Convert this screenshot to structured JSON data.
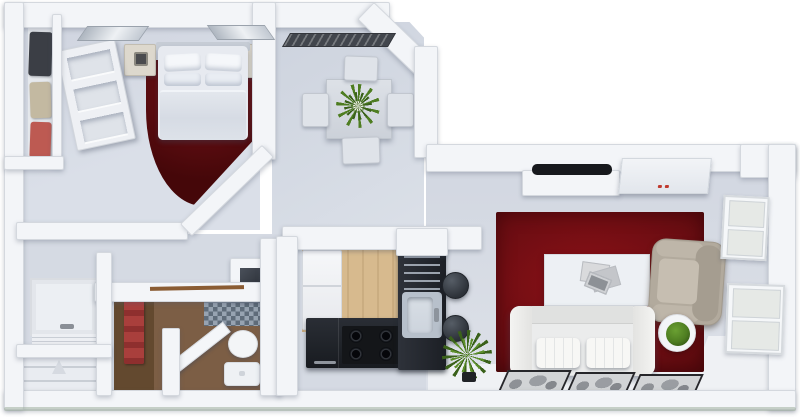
{
  "scene": {
    "description": "3D rendered top-down floor plan of a one-bedroom apartment",
    "view": "top-down orthographic 3D render",
    "background": "#ffffff"
  },
  "palette": {
    "wall": "#f3f5f8",
    "wall_line": "#d4d8de",
    "floor": "#d5dae3",
    "floor_bright": "#eff1f4",
    "wood": "#d7ba8e",
    "rug_bed_center": "#7c1316",
    "rug_bed_edge": "#450709",
    "rug_liv_center": "#8c1117",
    "rug_liv_edge": "#5c0a0e",
    "counter_dark": "#22262c",
    "counter_side": "#2e323a",
    "steel": "#b7c0cb",
    "sink_basin": "#cdd4dd",
    "bath_floor": "#7c5e45",
    "bath_floor_dark": "#63492f",
    "mosaic_a": "#97a3b1",
    "mosaic_b": "#5f6c7a",
    "towel": "#a93f3c",
    "plant": "#4e7d21",
    "plant_dark": "#3a611a",
    "sofa": "#ebecec",
    "cushion": "#f7f7f5",
    "armchair": "#b2aa9d",
    "armchair_dark": "#a29a8d",
    "tv": "#17191d",
    "clothes_dark": "#3b3e45",
    "clothes_beige": "#c3b9a1",
    "clothes_red": "#bd5a52",
    "fridge": "#f4f5f7",
    "outline": "#9fae9e"
  },
  "rooms": [
    {
      "id": "bedroom",
      "area": "top-left",
      "furniture": [
        "double-bed",
        "headboard",
        "four-pillows",
        "duvet",
        "nightstand-left",
        "nightstand-right",
        "table-lamps",
        "half-round-dark-red-rug",
        "wardrobe-with-clothes",
        "open-shelf-unit",
        "two-ceiling-lights",
        "diagonal-wall"
      ]
    },
    {
      "id": "dining-area",
      "area": "top-center",
      "furniture": [
        "square-table",
        "four-chairs",
        "centerpiece-plant",
        "wall-vent",
        "diagonal-corner-wall"
      ]
    },
    {
      "id": "kitchen",
      "area": "center",
      "furniture": [
        "wood-floor",
        "refrigerator",
        "dark-l-counter",
        "stove-four-burners",
        "drawer-stack",
        "sink-with-faucet",
        "breakfast-bar",
        "two-bar-stools",
        "palm-plant"
      ]
    },
    {
      "id": "bathroom",
      "area": "bottom-left",
      "furniture": [
        "brown-floor",
        "mosaic-tiles",
        "shower-stall",
        "toilet",
        "open-door-leaf",
        "red-towel",
        "towel-rail"
      ]
    },
    {
      "id": "hallway",
      "area": "left",
      "furniture": [
        "wall-cabinet-panel",
        "slatted-bench",
        "linen-closet-with-shelves"
      ]
    },
    {
      "id": "living-room",
      "area": "right",
      "furniture": [
        "wall-mounted-tv",
        "tv-console",
        "ac-cabinet-with-red-indicator",
        "red-area-rug",
        "coffee-table-with-magazines",
        "white-two-seat-sofa",
        "beige-armchair",
        "round-side-table-with-plant",
        "three-framed-floor-prints",
        "upper-window",
        "lower-window",
        "window-seat-platform"
      ]
    }
  ]
}
